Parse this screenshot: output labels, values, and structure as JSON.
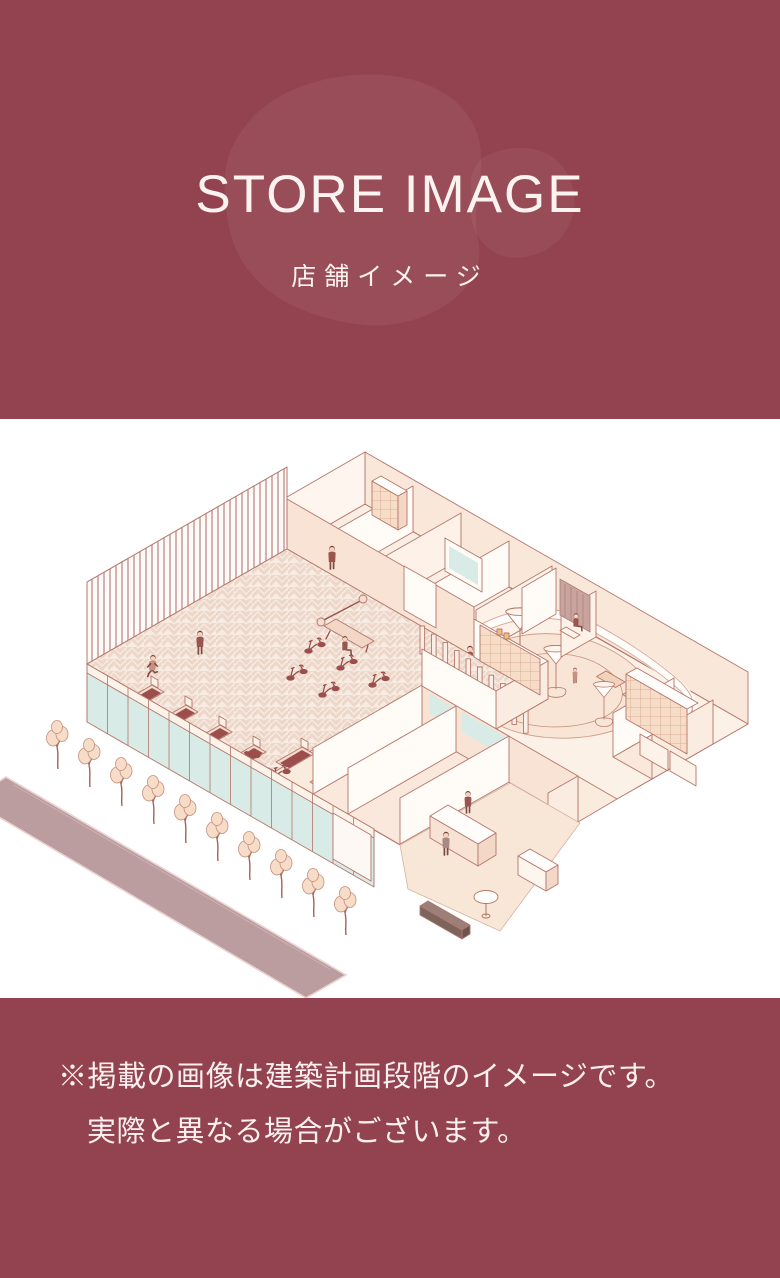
{
  "header": {
    "title": "STORE IMAGE",
    "subtitle": "店舗イメージ"
  },
  "footer": {
    "note_line1": "※掲載の画像は建築計画段階のイメージです。",
    "note_line2": "実際と異なる場合がございます。"
  },
  "colors": {
    "background_maroon": "#93434f",
    "blob_overlay": "#a05562",
    "heading_text": "#fcf3f1",
    "illustration_line": "#b5766a",
    "illustration_base_fill": "#f9ecdf",
    "glass_teal": "#d9ebe6",
    "equipment_maroon": "#9b4e4b",
    "foliage_peach": "#f7dcc7",
    "sidewalk_mauve": "#bb9c9f",
    "bench_dark": "#7c635c"
  }
}
